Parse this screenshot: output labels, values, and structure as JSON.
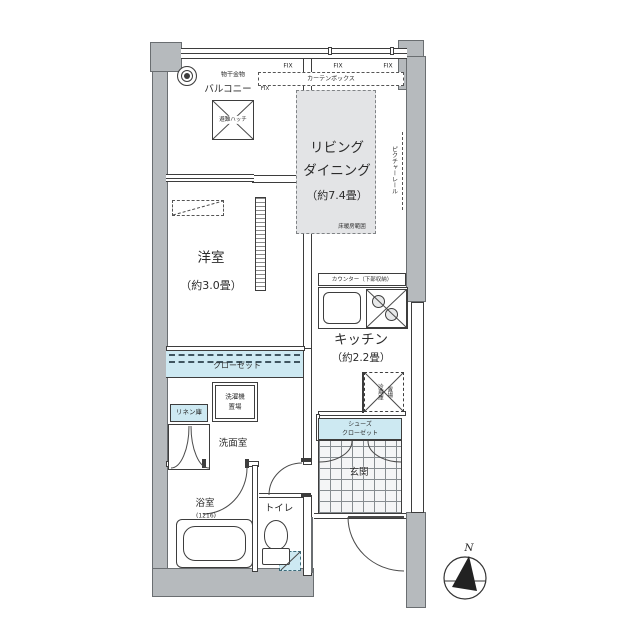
{
  "plan_type": "apartment-floor-plan",
  "colors": {
    "wall": "#b6babd",
    "closet_fill": "#cde9f2",
    "floor_heating_fill": "#e3e4e6",
    "line": "#3d3d3d"
  },
  "balcony": {
    "name": "バルコニー",
    "laundry_fixture": "物干金物",
    "escape_hatch": "避難ハッチ"
  },
  "living_dining": {
    "name": "リビング\nダイニング",
    "size": "（約7.4畳）",
    "curtain_box": "カーテンボックス",
    "fix_window": "FIX",
    "picture_rail": "ピクチャーレール",
    "floor_heating": "床暖房範囲"
  },
  "western_room": {
    "name": "洋室",
    "size": "（約3.0畳）"
  },
  "closet": {
    "name": "クローゼット"
  },
  "linen_closet": {
    "name": "リネン庫"
  },
  "washroom": {
    "name": "洗面室",
    "washer_space": "洗濯機\n置場"
  },
  "bathroom": {
    "name": "浴室",
    "size": "(1216)"
  },
  "toilet": {
    "name": "トイレ"
  },
  "kitchen": {
    "name": "キッチン",
    "size": "（約2.2畳）",
    "counter": "カウンター（下部収納）",
    "fridge_space": "冷蔵庫\n置場"
  },
  "entrance": {
    "name": "玄関",
    "shoes_closet": "シューズ\nクローゼット"
  },
  "compass": {
    "north_label": "N"
  }
}
